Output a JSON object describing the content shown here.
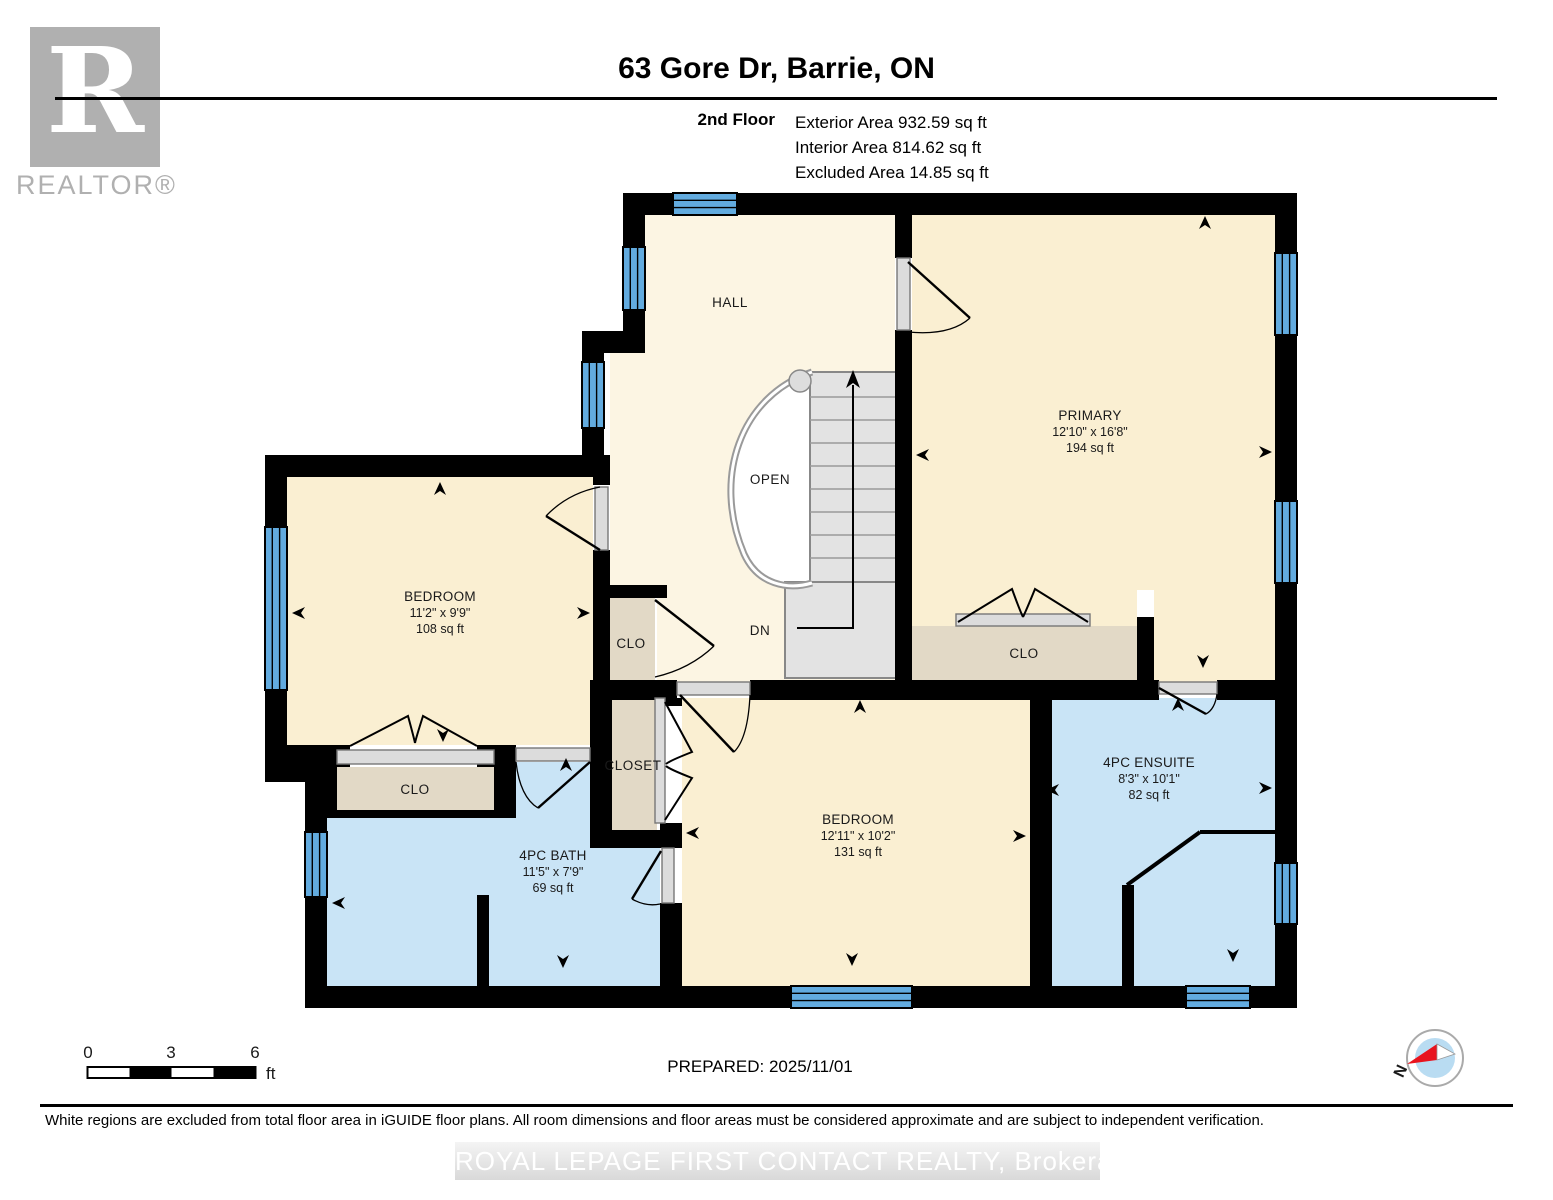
{
  "header": {
    "title": "63 Gore Dr, Barrie, ON",
    "floor_label": "2nd Floor",
    "exterior_area": "Exterior Area 932.59 sq ft",
    "interior_area": "Interior Area 814.62 sq ft",
    "excluded_area": "Excluded Area 14.85 sq ft"
  },
  "logo": {
    "r": "R",
    "realtor": "REALTOR®"
  },
  "plan": {
    "hall_label": "HALL",
    "open_label": "OPEN",
    "dn_label": "DN",
    "rooms": [
      {
        "name": "PRIMARY",
        "dims": "12'10\" x 16'8\"",
        "area": "194 sq ft"
      },
      {
        "name": "BEDROOM",
        "dims": "11'2\" x 9'9\"",
        "area": "108 sq ft"
      },
      {
        "name": "BEDROOM",
        "dims": "12'11\" x 10'2\"",
        "area": "131 sq ft"
      },
      {
        "name": "4PC ENSUITE",
        "dims": "8'3\" x 10'1\"",
        "area": "82 sq ft"
      },
      {
        "name": "4PC BATH",
        "dims": "11'5\" x 7'9\"",
        "area": "69 sq ft"
      }
    ],
    "closets": {
      "clo_center": "CLO",
      "closet": "CLOSET",
      "clo_left": "CLO",
      "clo_primary": "CLO"
    }
  },
  "scale_bar": {
    "tick0": "0",
    "tick1": "3",
    "tick2": "6",
    "unit": "ft"
  },
  "prepared_label": "PREPARED: 2025/11/01",
  "compass": {
    "north": "N"
  },
  "footer": {
    "disclaimer": "White regions are excluded from total floor area in iGUIDE floor plans. All room dimensions and floor areas must be considered approximate and are subject to independent verification.",
    "watermark": "ROYAL LEPAGE FIRST CONTACT REALTY, Brokerage"
  },
  "colors": {
    "wall": "#000000",
    "room_fill": "#FAEFD2",
    "hall_fill": "#FCF5E3",
    "wet_fill": "#C9E4F6",
    "closet_fill": "#E2D9C6",
    "window_blue": "#62ABDF",
    "stair_fill": "#E3E3E3",
    "door_slab": "#DCDCDC",
    "logo_gray": "#B0B0B0",
    "compass_red": "#E8141E",
    "compass_blue": "#B9DCF2"
  }
}
